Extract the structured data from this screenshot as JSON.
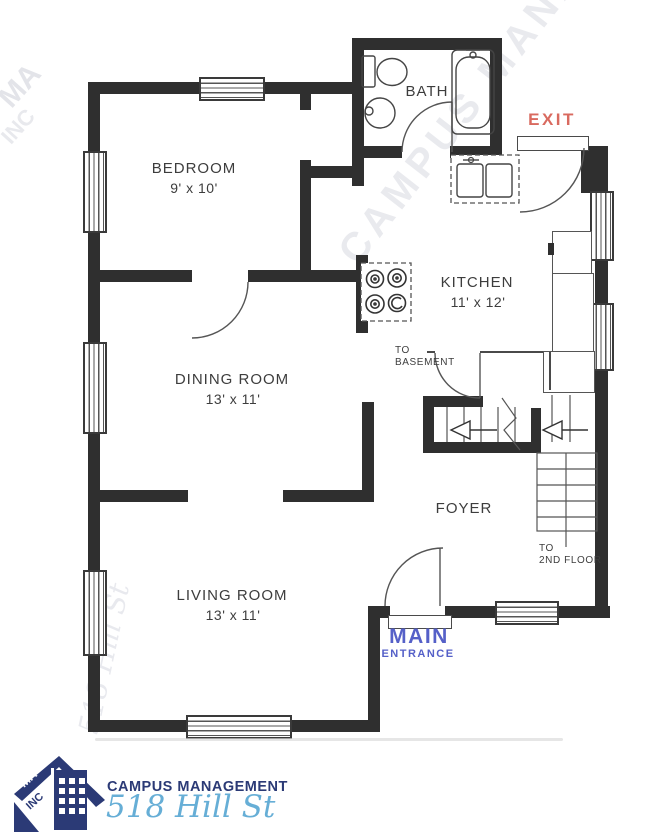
{
  "plan": {
    "rooms": {
      "bedroom": {
        "name": "BEDROOM",
        "dims": "9' x 10'"
      },
      "dining": {
        "name": "DINING ROOM",
        "dims": "13' x 11'"
      },
      "kitchen": {
        "name": "KITCHEN",
        "dims": "11' x 12'"
      },
      "living": {
        "name": "LIVING ROOM",
        "dims": "13' x 11'"
      },
      "bath": {
        "name": "BATH"
      },
      "foyer": {
        "name": "FOYER"
      }
    },
    "annotations": {
      "exit": "EXIT",
      "main_entrance_line1": "MAIN",
      "main_entrance_line2": "ENTRANCE",
      "to_basement_line1": "TO",
      "to_basement_line2": "BASEMENT",
      "to_second_floor_line1": "TO",
      "to_second_floor_line2": "2ND FLOOR"
    },
    "colors": {
      "wall": "#2f2f2f",
      "exit_red": "#d96a5f",
      "entrance_blue": "#5560c8",
      "logo_navy": "#2b3a76",
      "script_blue": "#66aed6"
    }
  },
  "watermark": {
    "text1": "CAMPUS MANAGEMENT",
    "text2": "518 Hill St",
    "corner1": "MA",
    "corner2": "INC"
  },
  "footer": {
    "company": "CAMPUS MANAGEMENT",
    "address": "518 Hill St",
    "logo_ma": "MA",
    "logo_inc": "INC"
  }
}
